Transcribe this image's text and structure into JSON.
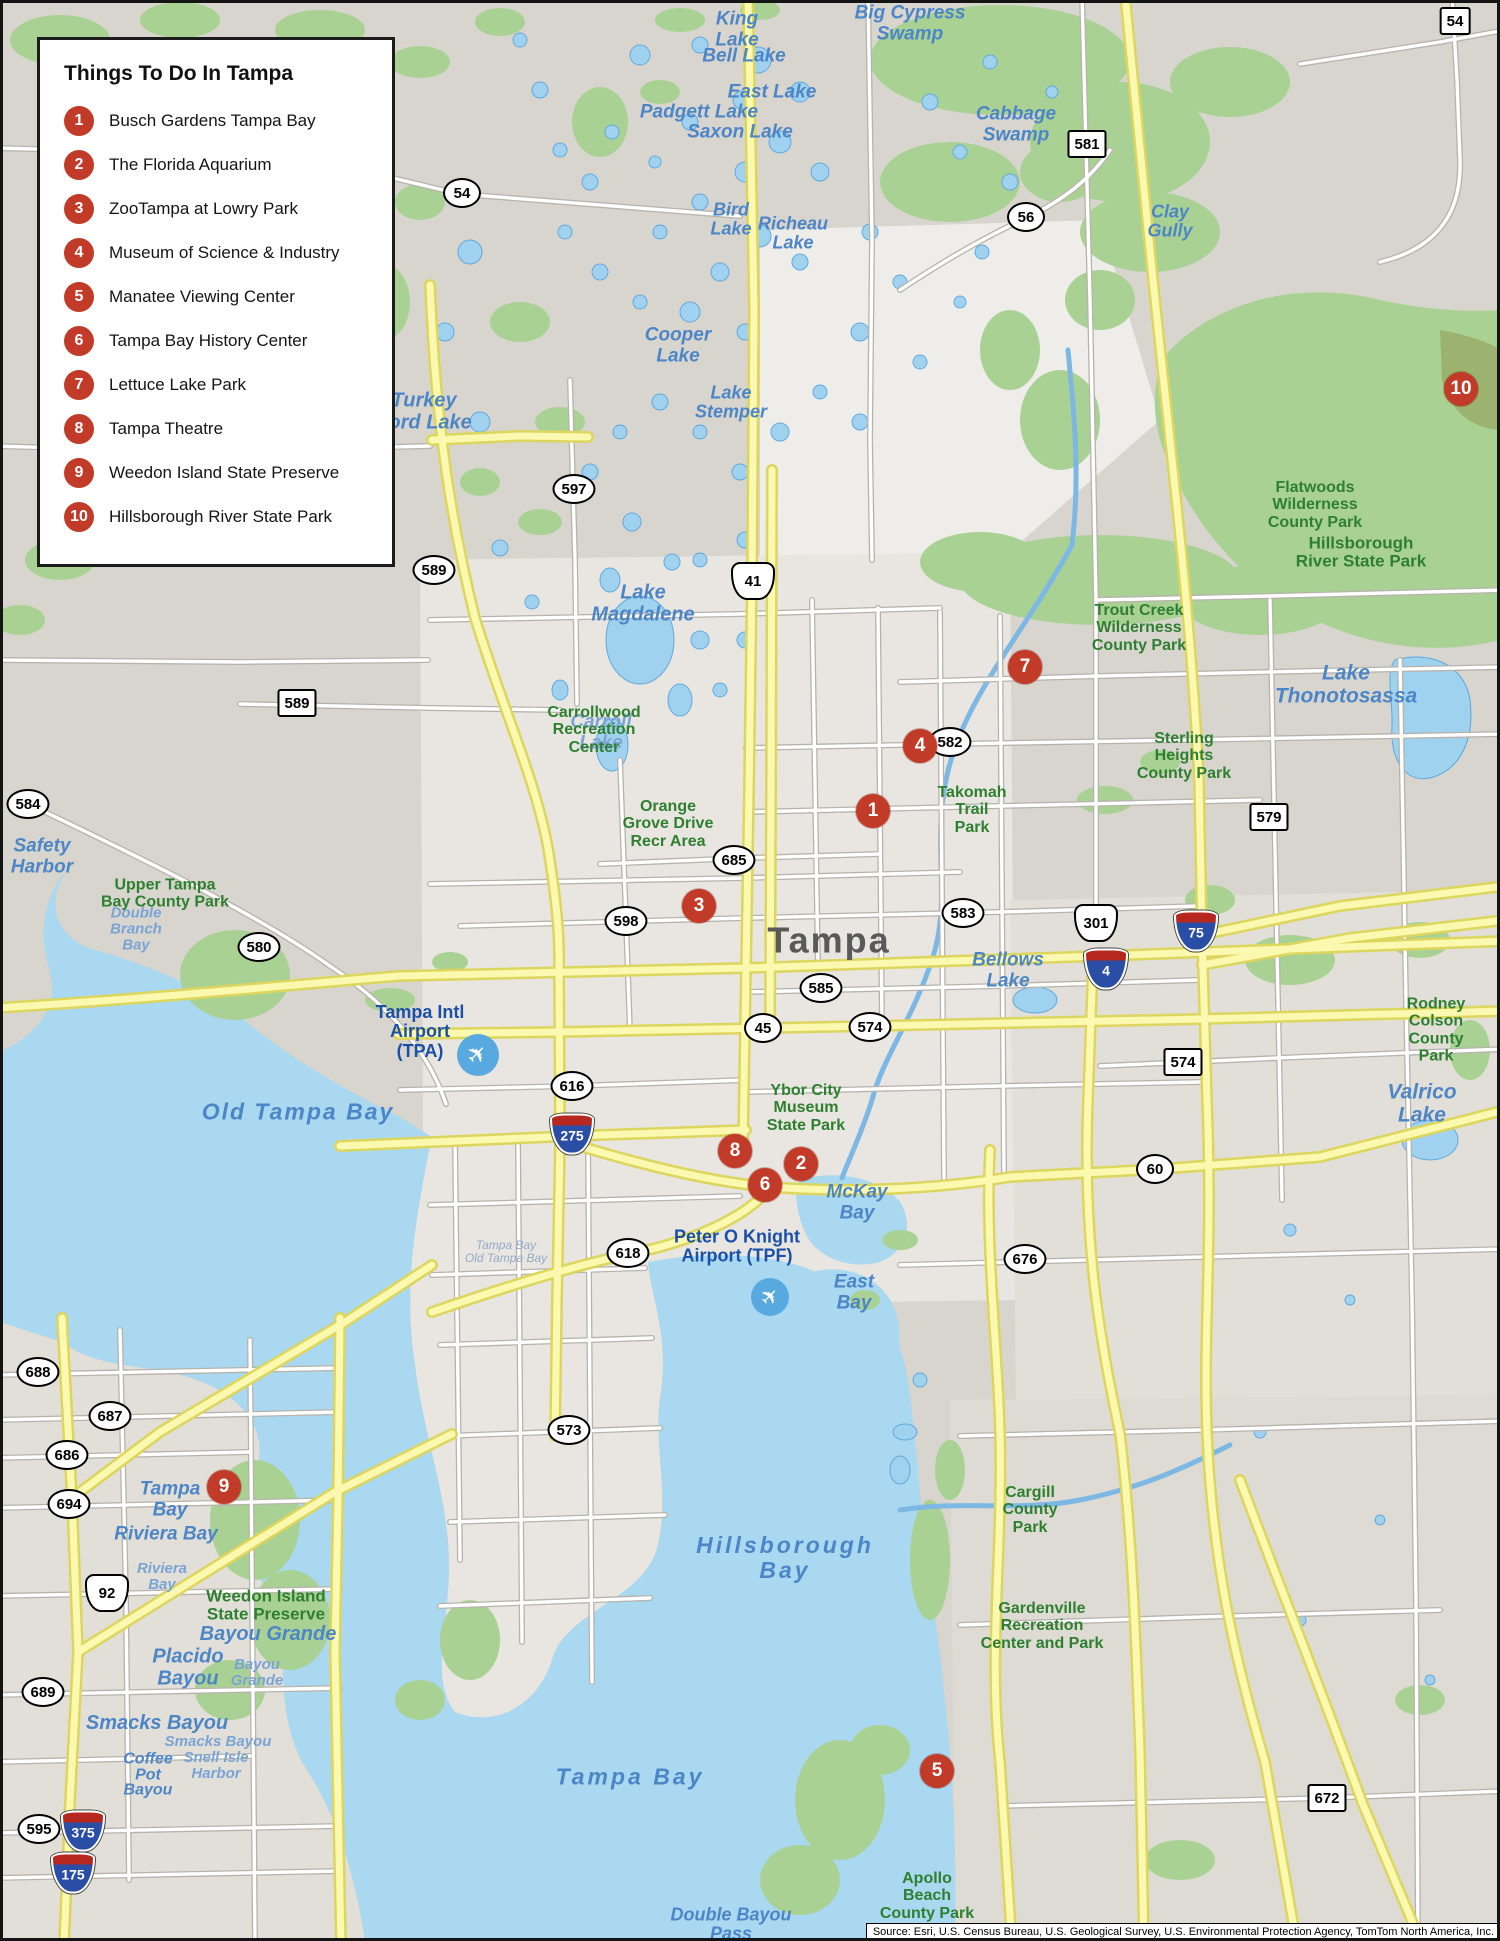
{
  "legend": {
    "title": "Things To Do In Tampa",
    "items": [
      {
        "num": "1",
        "label": "Busch Gardens Tampa Bay"
      },
      {
        "num": "2",
        "label": "The Florida Aquarium"
      },
      {
        "num": "3",
        "label": "ZooTampa at Lowry Park"
      },
      {
        "num": "4",
        "label": "Museum of Science & Industry"
      },
      {
        "num": "5",
        "label": "Manatee Viewing Center"
      },
      {
        "num": "6",
        "label": "Tampa Bay History Center"
      },
      {
        "num": "7",
        "label": "Lettuce Lake Park"
      },
      {
        "num": "8",
        "label": "Tampa Theatre"
      },
      {
        "num": "9",
        "label": "Weedon Island State Preserve"
      },
      {
        "num": "10",
        "label": "Hillsborough River State Park"
      }
    ]
  },
  "markers": [
    {
      "num": "1",
      "x": 873,
      "y": 811
    },
    {
      "num": "2",
      "x": 801,
      "y": 1164
    },
    {
      "num": "3",
      "x": 699,
      "y": 906
    },
    {
      "num": "4",
      "x": 920,
      "y": 746
    },
    {
      "num": "5",
      "x": 937,
      "y": 1771
    },
    {
      "num": "6",
      "x": 765,
      "y": 1185
    },
    {
      "num": "7",
      "x": 1025,
      "y": 667
    },
    {
      "num": "8",
      "x": 735,
      "y": 1151
    },
    {
      "num": "9",
      "x": 224,
      "y": 1487
    },
    {
      "num": "10",
      "x": 1461,
      "y": 389
    }
  ],
  "shields": [
    {
      "type": "oval",
      "label": "54",
      "x": 462,
      "y": 193
    },
    {
      "type": "oval",
      "label": "56",
      "x": 1026,
      "y": 217
    },
    {
      "type": "oval",
      "label": "597",
      "x": 574,
      "y": 489
    },
    {
      "type": "oval",
      "label": "589",
      "x": 434,
      "y": 570
    },
    {
      "type": "oval",
      "label": "598",
      "x": 626,
      "y": 921
    },
    {
      "type": "oval",
      "label": "685",
      "x": 734,
      "y": 860
    },
    {
      "type": "oval",
      "label": "582",
      "x": 950,
      "y": 742
    },
    {
      "type": "oval",
      "label": "583",
      "x": 963,
      "y": 913
    },
    {
      "type": "oval",
      "label": "585",
      "x": 821,
      "y": 988
    },
    {
      "type": "oval",
      "label": "45",
      "x": 763,
      "y": 1028
    },
    {
      "type": "oval",
      "label": "574",
      "x": 870,
      "y": 1027
    },
    {
      "type": "oval",
      "label": "616",
      "x": 572,
      "y": 1086
    },
    {
      "type": "oval",
      "label": "618",
      "x": 628,
      "y": 1253
    },
    {
      "type": "oval",
      "label": "60",
      "x": 1155,
      "y": 1169
    },
    {
      "type": "oval",
      "label": "676",
      "x": 1025,
      "y": 1259
    },
    {
      "type": "oval",
      "label": "573",
      "x": 569,
      "y": 1430
    },
    {
      "type": "oval",
      "label": "580",
      "x": 259,
      "y": 947
    },
    {
      "type": "oval",
      "label": "584",
      "x": 28,
      "y": 804
    },
    {
      "type": "oval",
      "label": "688",
      "x": 38,
      "y": 1372
    },
    {
      "type": "oval",
      "label": "687",
      "x": 110,
      "y": 1416
    },
    {
      "type": "oval",
      "label": "686",
      "x": 67,
      "y": 1455
    },
    {
      "type": "oval",
      "label": "694",
      "x": 69,
      "y": 1504
    },
    {
      "type": "oval",
      "label": "689",
      "x": 43,
      "y": 1692
    },
    {
      "type": "oval",
      "label": "595",
      "x": 39,
      "y": 1829
    },
    {
      "type": "rect",
      "label": "54",
      "x": 1455,
      "y": 21
    },
    {
      "type": "rect",
      "label": "581",
      "x": 1087,
      "y": 144
    },
    {
      "type": "rect",
      "label": "589",
      "x": 297,
      "y": 703
    },
    {
      "type": "rect",
      "label": "579",
      "x": 1269,
      "y": 817
    },
    {
      "type": "rect",
      "label": "574",
      "x": 1183,
      "y": 1062
    },
    {
      "type": "rect",
      "label": "672",
      "x": 1327,
      "y": 1798
    },
    {
      "type": "us",
      "label": "41",
      "x": 753,
      "y": 581
    },
    {
      "type": "us",
      "label": "301",
      "x": 1096,
      "y": 923
    },
    {
      "type": "us",
      "label": "92",
      "x": 107,
      "y": 1593
    },
    {
      "type": "int",
      "label": "75",
      "x": 1196,
      "y": 931
    },
    {
      "type": "int",
      "label": "4",
      "x": 1106,
      "y": 969
    },
    {
      "type": "int",
      "label": "275",
      "x": 572,
      "y": 1134
    },
    {
      "type": "int",
      "label": "375",
      "x": 83,
      "y": 1831
    },
    {
      "type": "int",
      "label": "175",
      "x": 73,
      "y": 1873
    }
  ],
  "labels": [
    {
      "t": "Tampa",
      "x": 829,
      "y": 941,
      "c": "city",
      "fs": 36
    },
    {
      "t": "King\nLake",
      "x": 737,
      "y": 30,
      "c": "water",
      "fs": 19
    },
    {
      "t": "Bell Lake",
      "x": 744,
      "y": 57,
      "c": "water",
      "fs": 19
    },
    {
      "t": "East Lake",
      "x": 772,
      "y": 93,
      "c": "water",
      "fs": 19
    },
    {
      "t": "Padgett Lake",
      "x": 699,
      "y": 113,
      "c": "water",
      "fs": 19
    },
    {
      "t": "Saxon Lake",
      "x": 740,
      "y": 133,
      "c": "water",
      "fs": 19
    },
    {
      "t": "Big Cypress\nSwamp",
      "x": 910,
      "y": 24,
      "c": "water",
      "fs": 19
    },
    {
      "t": "Cabbage\nSwamp",
      "x": 1016,
      "y": 125,
      "c": "water",
      "fs": 19
    },
    {
      "t": "Clay\nGully",
      "x": 1170,
      "y": 222,
      "c": "water",
      "fs": 18
    },
    {
      "t": "Bird\nLake",
      "x": 731,
      "y": 220,
      "c": "water",
      "fs": 18
    },
    {
      "t": "Richeau\nLake",
      "x": 793,
      "y": 234,
      "c": "water",
      "fs": 18
    },
    {
      "t": "Cooper\nLake",
      "x": 678,
      "y": 346,
      "c": "water",
      "fs": 19
    },
    {
      "t": "Lake\nStemper",
      "x": 731,
      "y": 403,
      "c": "water",
      "fs": 18
    },
    {
      "t": "Turkey\nFord Lake",
      "x": 424,
      "y": 412,
      "c": "water",
      "fs": 20
    },
    {
      "t": "Lake\nMagdalene",
      "x": 643,
      "y": 604,
      "c": "water",
      "fs": 20
    },
    {
      "t": "Carroll\nLake",
      "x": 601,
      "y": 733,
      "c": "water lt",
      "fs": 19
    },
    {
      "t": "Lake\nThonotosassa",
      "x": 1346,
      "y": 685,
      "c": "water",
      "fs": 21
    },
    {
      "t": "Bellows\nLake",
      "x": 1008,
      "y": 971,
      "c": "water",
      "fs": 19
    },
    {
      "t": "Valrico\nLake",
      "x": 1422,
      "y": 1104,
      "c": "water",
      "fs": 21
    },
    {
      "t": "Safety\nHarbor",
      "x": 42,
      "y": 857,
      "c": "water",
      "fs": 19
    },
    {
      "t": "Double\nBranch\nBay",
      "x": 136,
      "y": 930,
      "c": "water lt",
      "fs": 15
    },
    {
      "t": "Old Tampa Bay",
      "x": 298,
      "y": 1112,
      "c": "water",
      "fs": 23,
      "ls": 2
    },
    {
      "t": "Tampa Bay\nOld Tampa Bay",
      "x": 506,
      "y": 1252,
      "c": "water gy",
      "fs": 12
    },
    {
      "t": "McKay\nBay",
      "x": 857,
      "y": 1203,
      "c": "water",
      "fs": 19
    },
    {
      "t": "East\nBay",
      "x": 854,
      "y": 1293,
      "c": "water",
      "fs": 19
    },
    {
      "t": "Hillsborough\nBay",
      "x": 785,
      "y": 1558,
      "c": "water",
      "fs": 23,
      "ls": 3
    },
    {
      "t": "Tampa Bay",
      "x": 630,
      "y": 1777,
      "c": "water",
      "fs": 23,
      "ls": 3
    },
    {
      "t": "Tampa\nBay",
      "x": 170,
      "y": 1500,
      "c": "water",
      "fs": 19
    },
    {
      "t": "Riviera Bay",
      "x": 166,
      "y": 1535,
      "c": "water",
      "fs": 19
    },
    {
      "t": "Riviera\nBay",
      "x": 162,
      "y": 1577,
      "c": "water lt",
      "fs": 15
    },
    {
      "t": "Bayou Grande",
      "x": 268,
      "y": 1635,
      "c": "water",
      "fs": 20
    },
    {
      "t": "Placido\nBayou",
      "x": 188,
      "y": 1668,
      "c": "water",
      "fs": 20
    },
    {
      "t": "Bayou\nGrande",
      "x": 257,
      "y": 1673,
      "c": "water lt",
      "fs": 15
    },
    {
      "t": "Smacks Bayou",
      "x": 157,
      "y": 1724,
      "c": "water",
      "fs": 20
    },
    {
      "t": "Smacks Bayou",
      "x": 218,
      "y": 1742,
      "c": "water lt",
      "fs": 15
    },
    {
      "t": "Snell Isle\nHarbor",
      "x": 216,
      "y": 1766,
      "c": "water lt",
      "fs": 15
    },
    {
      "t": "Coffee\nPot\nBayou",
      "x": 148,
      "y": 1775,
      "c": "water",
      "fs": 16,
      "lh": 0.98
    },
    {
      "t": "Double Bayou\nPass",
      "x": 731,
      "y": 1925,
      "c": "water",
      "fs": 18
    },
    {
      "t": "Upper Tampa\nBay County Park",
      "x": 165,
      "y": 894,
      "c": "park",
      "fs": 16
    },
    {
      "t": "Carrollwood\nRecreation\nCenter",
      "x": 594,
      "y": 730,
      "c": "park",
      "fs": 16
    },
    {
      "t": "Orange\nGrove Drive\nRecr Area",
      "x": 668,
      "y": 824,
      "c": "park",
      "fs": 16
    },
    {
      "t": "Takomah\nTrail\nPark",
      "x": 972,
      "y": 810,
      "c": "park",
      "fs": 16
    },
    {
      "t": "Trout Creek\nWilderness\nCounty Park",
      "x": 1139,
      "y": 628,
      "c": "park",
      "fs": 16
    },
    {
      "t": "Flatwoods\nWilderness\nCounty Park",
      "x": 1315,
      "y": 505,
      "c": "park",
      "fs": 16
    },
    {
      "t": "Hillsborough\nRiver State Park",
      "x": 1361,
      "y": 553,
      "c": "park",
      "fs": 17
    },
    {
      "t": "Sterling\nHeights\nCounty Park",
      "x": 1184,
      "y": 756,
      "c": "park",
      "fs": 16
    },
    {
      "t": "Rodney\nColson\nCounty Park",
      "x": 1436,
      "y": 1030,
      "c": "park",
      "fs": 16
    },
    {
      "t": "Ybor City\nMuseum\nState Park",
      "x": 806,
      "y": 1108,
      "c": "park",
      "fs": 16
    },
    {
      "t": "Cargill\nCounty\nPark",
      "x": 1030,
      "y": 1510,
      "c": "park",
      "fs": 16
    },
    {
      "t": "Gardenville\nRecreation\nCenter and Park",
      "x": 1042,
      "y": 1626,
      "c": "park",
      "fs": 16
    },
    {
      "t": "Weedon Island\nState Preserve",
      "x": 266,
      "y": 1606,
      "c": "park",
      "fs": 17
    },
    {
      "t": "Apollo\nBeach\nCounty Park",
      "x": 927,
      "y": 1896,
      "c": "park",
      "fs": 16
    },
    {
      "t": "Tampa Intl\nAirport\n(TPA)",
      "x": 420,
      "y": 1032,
      "c": "air",
      "fs": 18
    },
    {
      "t": "Peter O Knight\nAirport (TPF)",
      "x": 737,
      "y": 1247,
      "c": "air",
      "fs": 18
    }
  ],
  "airport_icons": [
    {
      "x": 478,
      "y": 1055,
      "r": 21
    },
    {
      "x": 770,
      "y": 1297,
      "r": 19
    }
  ],
  "source": {
    "text": "Source: Esri, U.S. Census Bureau, U.S. Geological Survey, U.S. Environmental Protection Agency, TomTom North America, Inc."
  },
  "colors": {
    "marker_red": "#c23a28",
    "park_green": "#2e8030",
    "water_label_blue": "#4d86c6",
    "airport_blue": "#1b50a8",
    "water_fill": "#a9d8f0",
    "green_fill": "#aad194",
    "highway_yellow": "#fbf8b0",
    "land_gray": "#d8d5cf"
  }
}
